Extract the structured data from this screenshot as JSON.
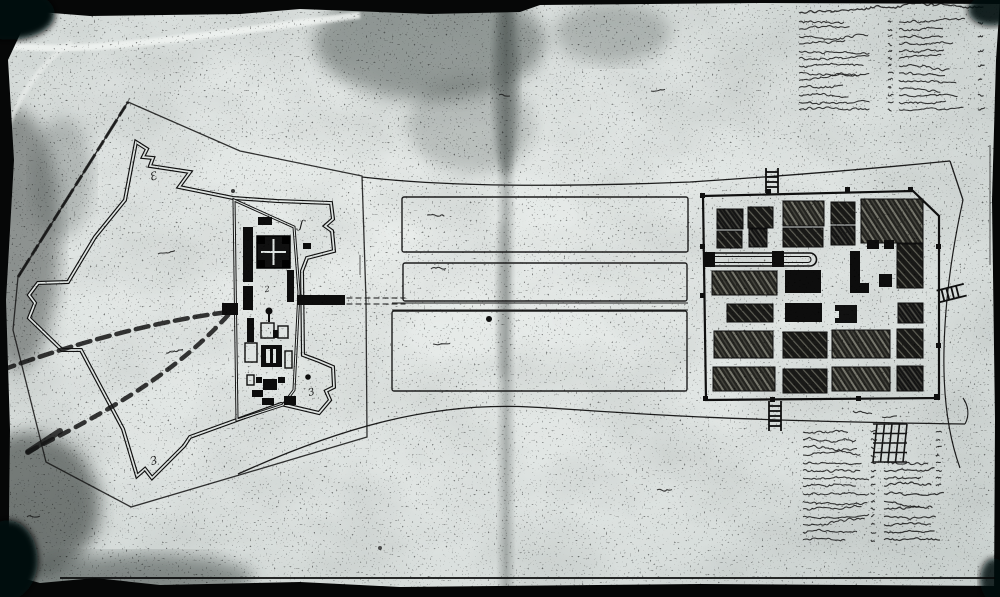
{
  "palette": {
    "paper": "#dfe4e2",
    "paper_light": "#eef1ef",
    "ink": "#0f0f0f",
    "ink_soft": "#242424",
    "stain": "#525a57"
  },
  "map_data": {
    "type": "historic-fortification-plan",
    "fort": {
      "bastion_labels": [
        {
          "text": "Ɛ",
          "x": 151,
          "y": 181,
          "rot": -18,
          "size": 11
        },
        {
          "text": "ʃ",
          "x": 299,
          "y": 228,
          "rot": 12,
          "size": 12
        },
        {
          "text": "2",
          "x": 265,
          "y": 292,
          "rot": -8,
          "size": 8
        },
        {
          "text": "3",
          "x": 309,
          "y": 396,
          "rot": -14,
          "size": 10
        },
        {
          "text": "Ɛ",
          "x": 156,
          "y": 455,
          "rot": 158,
          "size": 11
        }
      ],
      "buildings": [
        {
          "x": 258,
          "y": 217,
          "w": 14,
          "h": 8,
          "t": "s"
        },
        {
          "x": 243,
          "y": 227,
          "w": 10,
          "h": 55,
          "t": "s"
        },
        {
          "x": 243,
          "y": 286,
          "w": 10,
          "h": 24,
          "t": "s"
        },
        {
          "x": 257,
          "y": 236,
          "w": 33,
          "h": 32,
          "t": "keep"
        },
        {
          "x": 287,
          "y": 270,
          "w": 7,
          "h": 32,
          "t": "s"
        },
        {
          "x": 303,
          "y": 243,
          "w": 8,
          "h": 6,
          "t": "s"
        },
        {
          "x": 247,
          "y": 318,
          "w": 7,
          "h": 24,
          "t": "s"
        },
        {
          "x": 261,
          "y": 323,
          "w": 13,
          "h": 15,
          "t": "o"
        },
        {
          "x": 273,
          "y": 330,
          "w": 12,
          "h": 8,
          "t": "s"
        },
        {
          "x": 278,
          "y": 326,
          "w": 10,
          "h": 12,
          "t": "o"
        },
        {
          "x": 245,
          "y": 343,
          "w": 12,
          "h": 19,
          "t": "o"
        },
        {
          "x": 261,
          "y": 345,
          "w": 21,
          "h": 22,
          "t": "m"
        },
        {
          "x": 285,
          "y": 351,
          "w": 7,
          "h": 17,
          "t": "o"
        },
        {
          "x": 247,
          "y": 375,
          "w": 7,
          "h": 10,
          "t": "o"
        },
        {
          "x": 256,
          "y": 377,
          "w": 6,
          "h": 6,
          "t": "s"
        },
        {
          "x": 263,
          "y": 379,
          "w": 14,
          "h": 11,
          "t": "s"
        },
        {
          "x": 278,
          "y": 377,
          "w": 7,
          "h": 6,
          "t": "s"
        },
        {
          "x": 252,
          "y": 390,
          "w": 11,
          "h": 7,
          "t": "s"
        },
        {
          "x": 262,
          "y": 398,
          "w": 12,
          "h": 7,
          "t": "s"
        },
        {
          "x": 297,
          "y": 295,
          "w": 48,
          "h": 10,
          "t": "s"
        },
        {
          "x": 222,
          "y": 303,
          "w": 16,
          "h": 12,
          "t": "s"
        },
        {
          "x": 284,
          "y": 396,
          "w": 12,
          "h": 9,
          "t": "s"
        }
      ],
      "pin": {
        "x": 269,
        "y": 311,
        "r": 3.5
      },
      "dot": {
        "x": 308,
        "y": 377,
        "r": 2.8
      }
    },
    "strips": [
      {
        "x": 402,
        "y": 197,
        "w": 286,
        "h": 55
      },
      {
        "x": 403,
        "y": 263,
        "w": 284,
        "h": 38
      },
      {
        "x": 392,
        "y": 311,
        "w": 295,
        "h": 80
      }
    ],
    "town": {
      "blocks": [
        {
          "x": 717,
          "y": 209,
          "w": 26,
          "h": 20,
          "f": "h1"
        },
        {
          "x": 748,
          "y": 207,
          "w": 25,
          "h": 21,
          "f": "h2"
        },
        {
          "x": 783,
          "y": 201,
          "w": 41,
          "h": 25,
          "f": "h3"
        },
        {
          "x": 831,
          "y": 202,
          "w": 24,
          "h": 22,
          "f": "h2"
        },
        {
          "x": 861,
          "y": 199,
          "w": 62,
          "h": 44,
          "f": "h3"
        },
        {
          "x": 717,
          "y": 231,
          "w": 25,
          "h": 17,
          "f": "h2"
        },
        {
          "x": 749,
          "y": 229,
          "w": 18,
          "h": 18,
          "f": "h1"
        },
        {
          "x": 783,
          "y": 228,
          "w": 40,
          "h": 19,
          "f": "h2"
        },
        {
          "x": 831,
          "y": 226,
          "w": 24,
          "h": 19,
          "f": "h1"
        },
        {
          "x": 712,
          "y": 271,
          "w": 65,
          "h": 24,
          "f": "h3"
        },
        {
          "x": 785,
          "y": 270,
          "w": 36,
          "h": 23,
          "f": "s"
        },
        {
          "x": 879,
          "y": 274,
          "w": 13,
          "h": 13,
          "f": "s"
        },
        {
          "x": 897,
          "y": 244,
          "w": 26,
          "h": 44,
          "f": "h2"
        },
        {
          "x": 727,
          "y": 304,
          "w": 46,
          "h": 18,
          "f": "h2"
        },
        {
          "x": 785,
          "y": 303,
          "w": 37,
          "h": 19,
          "f": "s"
        },
        {
          "x": 835,
          "y": 305,
          "w": 22,
          "h": 18,
          "f": "notch"
        },
        {
          "x": 898,
          "y": 303,
          "w": 25,
          "h": 20,
          "f": "h1"
        },
        {
          "x": 714,
          "y": 331,
          "w": 59,
          "h": 27,
          "f": "h3"
        },
        {
          "x": 783,
          "y": 332,
          "w": 44,
          "h": 26,
          "f": "h2"
        },
        {
          "x": 832,
          "y": 330,
          "w": 58,
          "h": 28,
          "f": "h3"
        },
        {
          "x": 897,
          "y": 329,
          "w": 26,
          "h": 29,
          "f": "h2"
        },
        {
          "x": 713,
          "y": 367,
          "w": 62,
          "h": 24,
          "f": "h3"
        },
        {
          "x": 783,
          "y": 369,
          "w": 44,
          "h": 24,
          "f": "h2"
        },
        {
          "x": 832,
          "y": 367,
          "w": 58,
          "h": 24,
          "f": "h3"
        },
        {
          "x": 897,
          "y": 366,
          "w": 26,
          "h": 25,
          "f": "h1"
        }
      ],
      "small_buildings": [
        {
          "x": 850,
          "y": 251,
          "w": 10,
          "h": 42,
          "f": "s"
        },
        {
          "x": 860,
          "y": 283,
          "w": 9,
          "h": 10,
          "f": "s"
        },
        {
          "x": 867,
          "y": 240,
          "w": 12,
          "h": 9,
          "f": "s"
        },
        {
          "x": 884,
          "y": 240,
          "w": 10,
          "h": 9,
          "f": "s"
        },
        {
          "x": 703,
          "y": 252,
          "w": 12,
          "h": 15,
          "f": "s"
        },
        {
          "x": 772,
          "y": 251,
          "w": 12,
          "h": 16,
          "f": "s"
        }
      ],
      "stadium": {
        "x1": 712,
        "y1": 253,
        "x2": 823,
        "y2": 266
      }
    },
    "scribbles": [
      {
        "x": 158,
        "y": 254,
        "w": 17,
        "rot": -5
      },
      {
        "x": 166,
        "y": 353,
        "w": 17,
        "rot": -5
      },
      {
        "x": 427,
        "y": 215,
        "w": 17,
        "rot": -3
      },
      {
        "x": 431,
        "y": 269,
        "w": 15,
        "rot": -3
      },
      {
        "x": 433,
        "y": 344,
        "w": 17,
        "rot": -3
      },
      {
        "x": 499,
        "y": 95,
        "w": 11,
        "rot": 0
      },
      {
        "x": 651,
        "y": 91,
        "w": 14,
        "rot": -5
      },
      {
        "x": 657,
        "y": 490,
        "w": 15,
        "rot": -4
      },
      {
        "x": 27,
        "y": 517,
        "w": 13,
        "rot": -3
      },
      {
        "x": 853,
        "y": 411,
        "w": 19,
        "rot": 4
      },
      {
        "x": 882,
        "y": 417,
        "w": 15,
        "rot": -7
      }
    ],
    "legend_top_right": {
      "x": 799,
      "y": 13,
      "header_w": 186,
      "rows": 13,
      "row_h": 7.3,
      "col1_x": 799,
      "col1_w": 72,
      "mid_x": 888,
      "col2_x": 899,
      "col2_w": 66,
      "num_x": 978
    },
    "legend_bottom_right": {
      "x": 803,
      "y": 432,
      "rows": 15,
      "row_h": 7.7,
      "col1_x": 803,
      "col1_w": 62,
      "mid_x": 871,
      "col2_x": 884,
      "col2_w": 52,
      "num_x": 936,
      "hatch_block": {
        "x": 877,
        "y": 424,
        "w": 30,
        "h": 38
      }
    }
  }
}
